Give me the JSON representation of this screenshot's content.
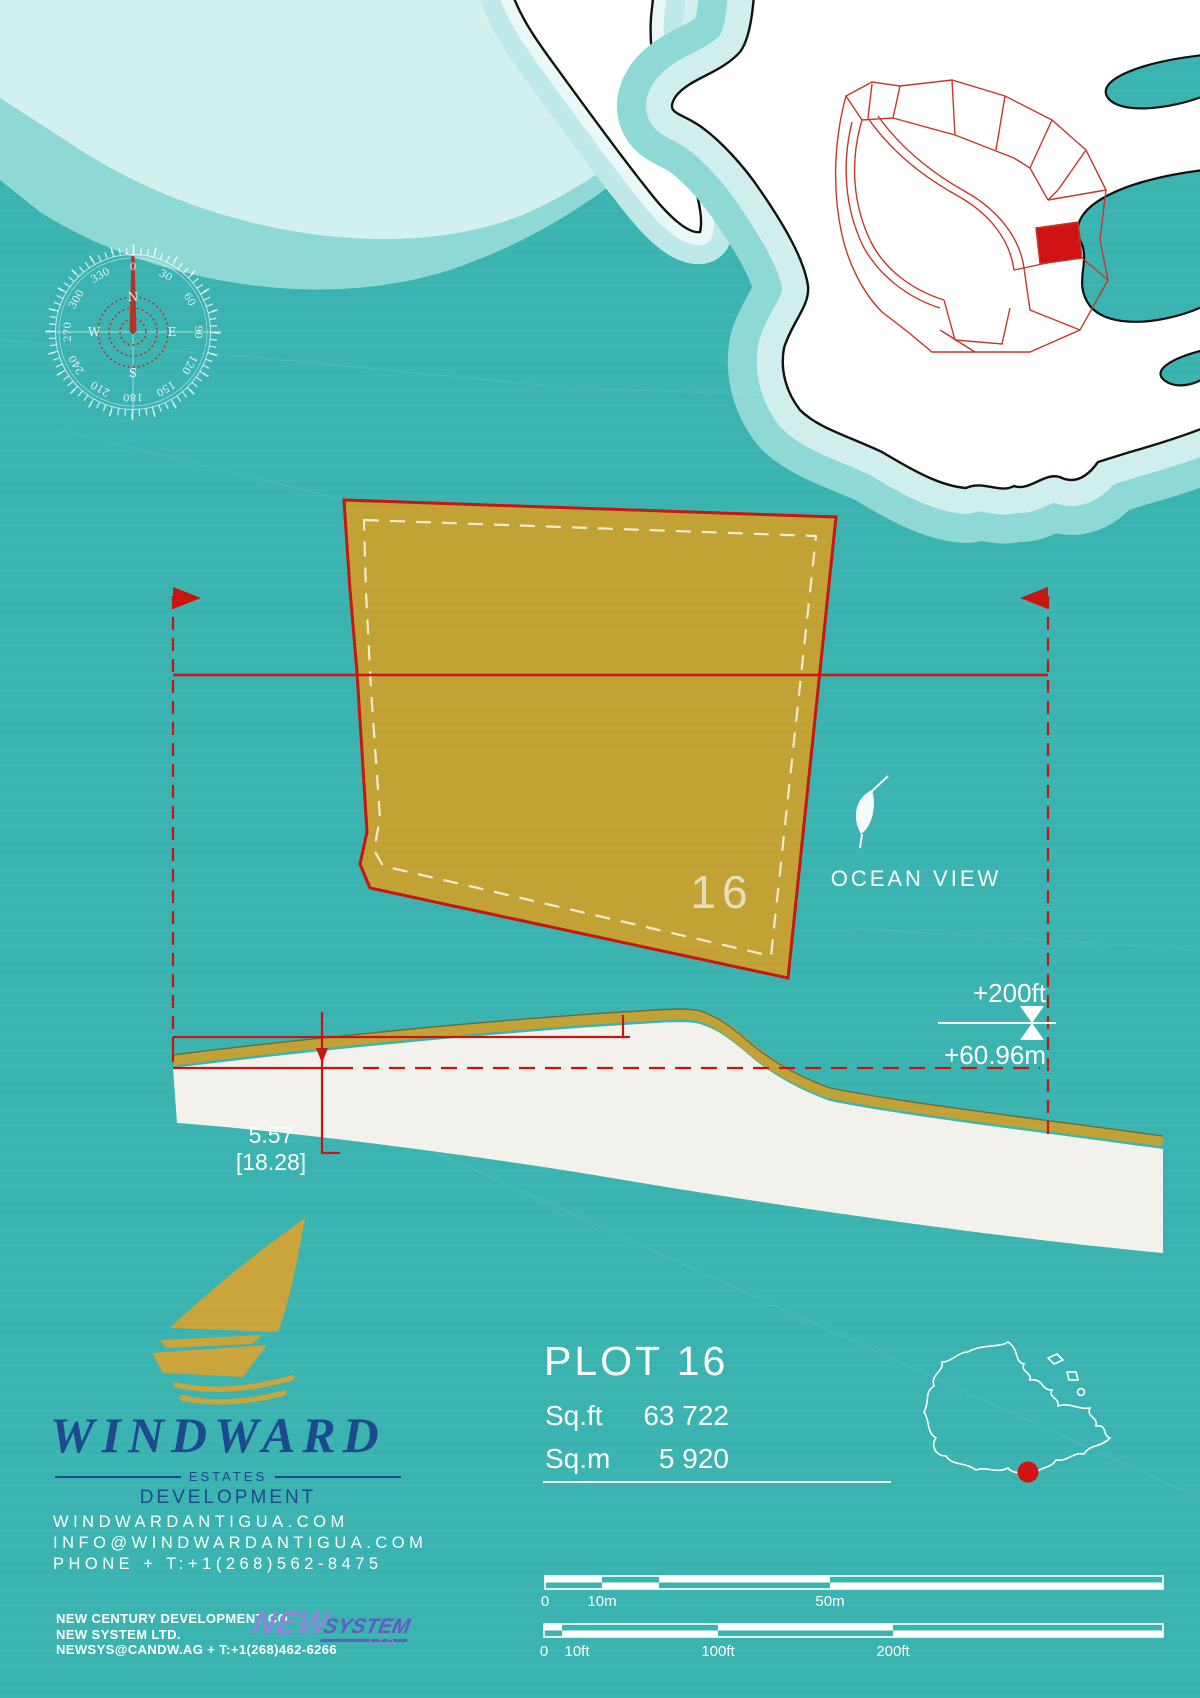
{
  "colors": {
    "ocean": "#3ab3b1",
    "shallow_mid": "#8ed8d5",
    "shallow_light": "#d2f0ee",
    "land": "#ffffff",
    "coast_outline": "#1a1a1a",
    "plot_gold": "#c2a135",
    "dimension_red": "#c8150f",
    "subdivision_red": "#c0392b",
    "highlight_red": "#d01212",
    "brand_navy": "#1d4a8f",
    "plot_label_cream": "#e6dfbd",
    "newsystem_purple": "#655bbd"
  },
  "compass": {
    "degrees": [
      "0",
      "30",
      "60",
      "90",
      "120",
      "150",
      "180",
      "210",
      "240",
      "270",
      "300",
      "330"
    ],
    "cardinals": [
      "N",
      "E",
      "S",
      "W"
    ]
  },
  "plot": {
    "number": "16",
    "ocean_view": "OCEAN VIEW"
  },
  "elevation": {
    "feet": "+200ft",
    "meters": "+60.96m"
  },
  "section": {
    "value": "5.57",
    "bracket": "[18.28]"
  },
  "plot_info": {
    "title": "PLOT 16",
    "sqft_label": "Sq.ft",
    "sqft_value": "63 722",
    "sqm_label": "Sq.m",
    "sqm_value": "5 920"
  },
  "brand": {
    "name": "WINDWARD",
    "estates": "ESTATES",
    "development": "DEVELOPMENT",
    "website": "WINDWARDANTIGUA.COM",
    "email": "INFO@WINDWARDANTIGUA.COM",
    "phone": "PHONE + T:+1(268)562-8475"
  },
  "developer": {
    "line1": "NEW CENTURY DEVELOPMENT CO.",
    "line2": "NEW SYSTEM LTD.",
    "line3": "NEWSYS@CANDW.AG + T:+1(268)462-6266",
    "logo_new": "NEW",
    "logo_system": "SYSTEM",
    "logo_ltd": "LTD"
  },
  "scale": {
    "meters": [
      "0",
      "10m",
      "50m"
    ],
    "feet": [
      "0",
      "10ft",
      "100ft",
      "200ft"
    ]
  }
}
